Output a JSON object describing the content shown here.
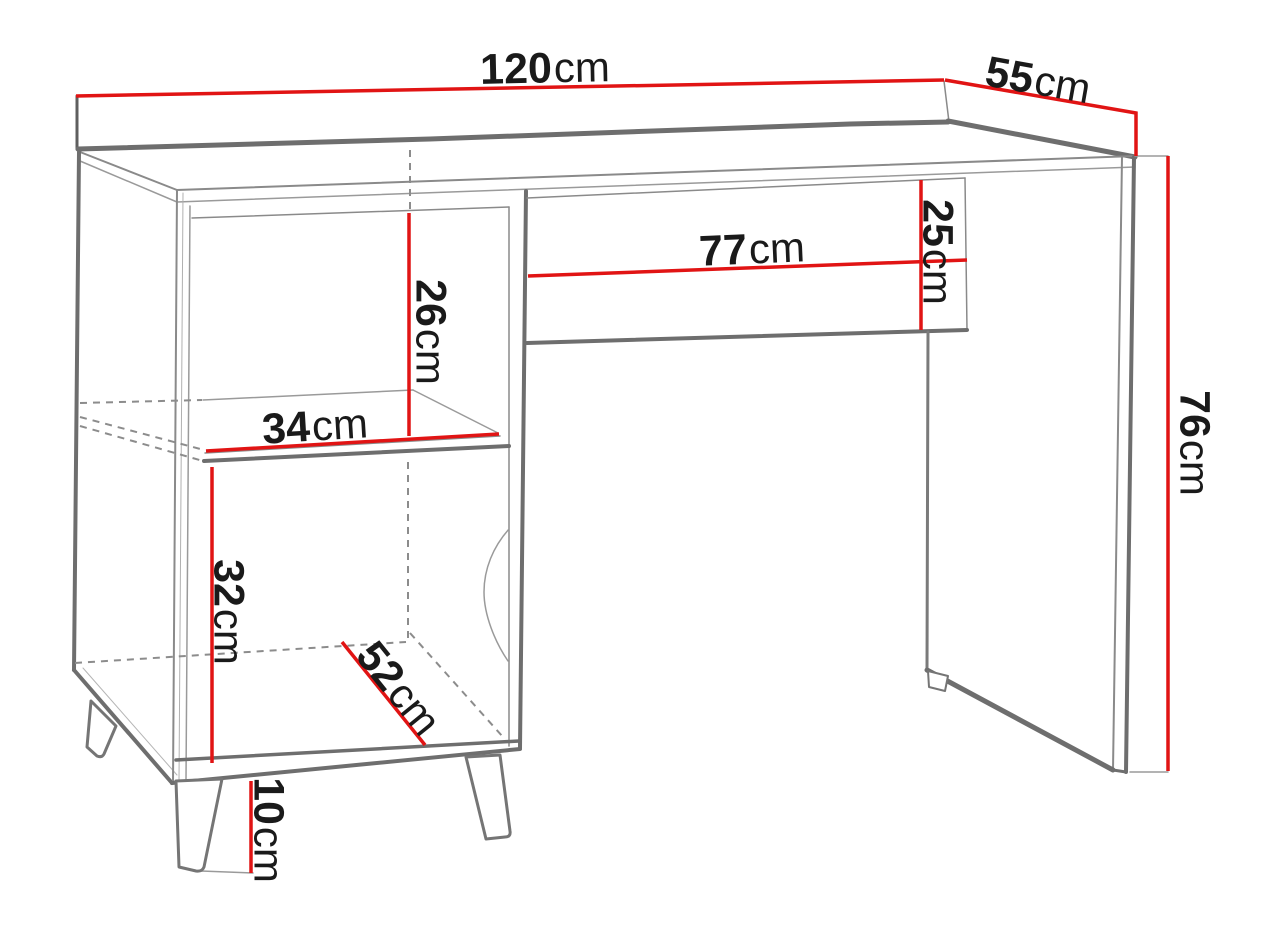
{
  "title": "Desk dimension diagram",
  "colors": {
    "dimension_line": "#e11414",
    "outline_dark": "#6e6e6e",
    "outline_light": "#9a9a9a",
    "text": "#1a1a1a",
    "background": "#ffffff"
  },
  "dimensions": {
    "desk_width_top": {
      "value": "120",
      "unit": "cm"
    },
    "desk_depth": {
      "value": "55",
      "unit": "cm"
    },
    "desk_height": {
      "value": "76",
      "unit": "cm"
    },
    "drawer_width": {
      "value": "77",
      "unit": "cm"
    },
    "drawer_height": {
      "value": "25",
      "unit": "cm"
    },
    "shelf_opening_height": {
      "value": "26",
      "unit": "cm"
    },
    "shelf_width": {
      "value": "34",
      "unit": "cm"
    },
    "cabinet_opening_height": {
      "value": "32",
      "unit": "cm"
    },
    "cabinet_interior_depth": {
      "value": "52",
      "unit": "cm"
    },
    "leg_height": {
      "value": "10",
      "unit": "cm"
    }
  }
}
